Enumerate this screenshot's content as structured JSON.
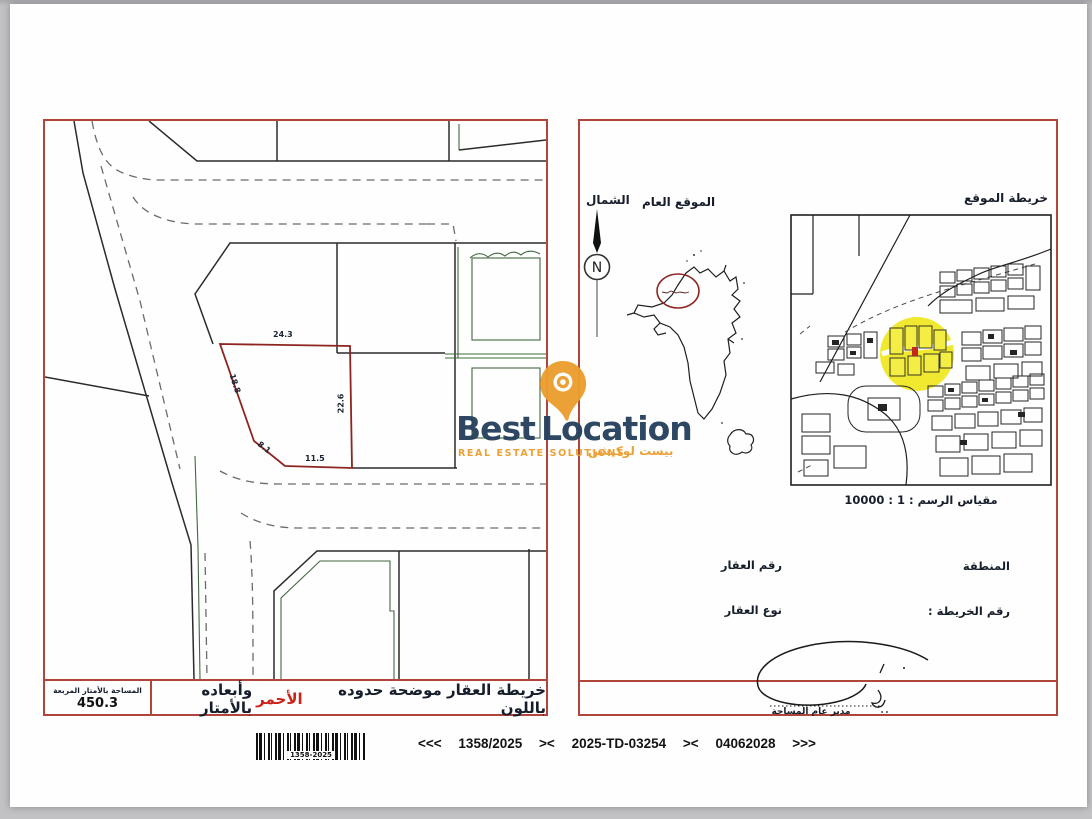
{
  "colors": {
    "border_red": "#b0453c",
    "parcel_red": "#8e2420",
    "line_green": "#41683f",
    "dash_grey": "#6b6b6b",
    "note_red": "#cc2318",
    "brand_navy": "#26415e",
    "brand_orange": "#ec9e2e",
    "highlight_yellow": "#f0e71e"
  },
  "brand": {
    "name_first": "Best",
    "name_second": "Location",
    "tagline": "REAL ESTATE SOLUTIONS",
    "tagline_ar": "بيست لوكيشن"
  },
  "left_panel": {
    "dimensions": {
      "top": "24.3",
      "left": "18.8",
      "right": "22.6",
      "corner": "8.1",
      "bottom": "11.5"
    },
    "area_box": {
      "title": "المساحة بالأمتار المربعة",
      "value": "450.3"
    },
    "note": {
      "prefix": "خريطة العقار موضحة حدوده باللون",
      "highlight": "الأحمر",
      "suffix": "وأبعاده بالأمتار"
    }
  },
  "right_panel": {
    "north_label": "الشمال",
    "general_location_label": "الموقع العام",
    "location_map_label": "خريطة الموقع",
    "compass_letter": "N",
    "scale_label": "مقياس الرسم : 1 : 10000",
    "fields": {
      "property_number": "رقم العقار",
      "region": "المنطقة",
      "property_type": "نوع العقار",
      "map_number": "رقم الخريطة :"
    },
    "signature_title": "مدير عام المساحة"
  },
  "footer": {
    "barcode_label": "1358-2025",
    "segments": [
      "<<<",
      "1358/2025",
      "><",
      "2025-TD-03254",
      "><",
      "04062028",
      ">>>"
    ]
  }
}
